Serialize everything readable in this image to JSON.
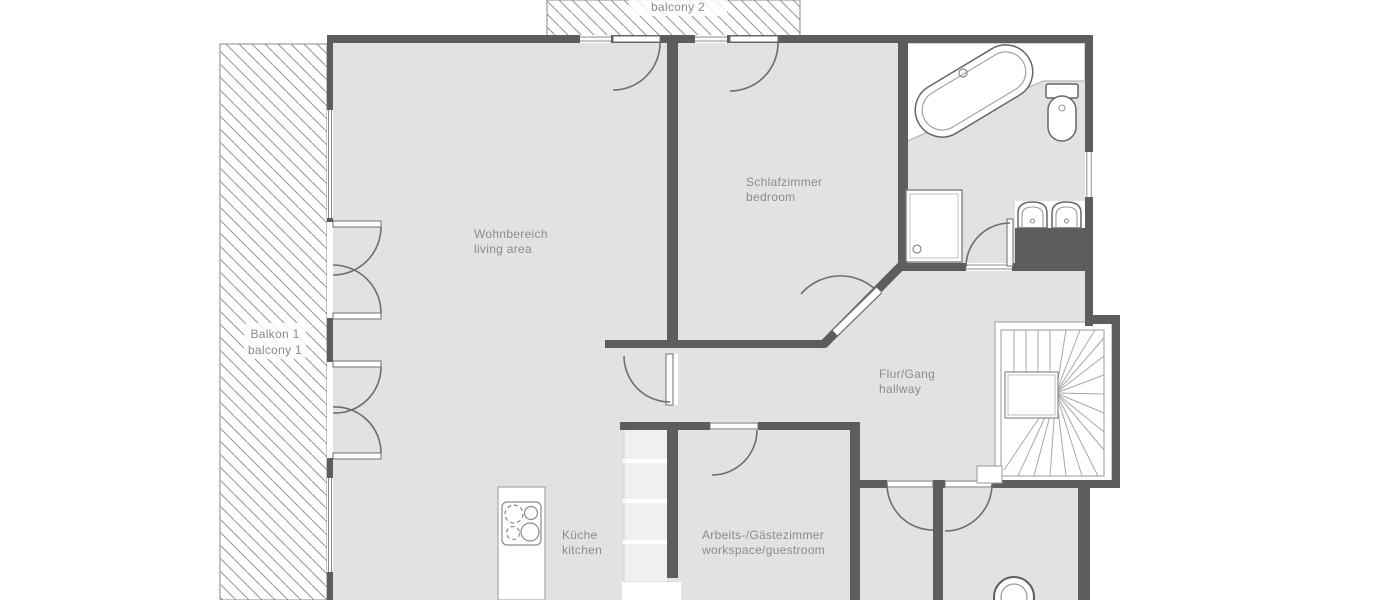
{
  "plan": {
    "type": "apartment-floor-plan",
    "rooms": {
      "balcony2": {
        "line2": "balcony 2"
      },
      "balcony1": {
        "line1": "Balkon 1",
        "line2": "balcony 1"
      },
      "living": {
        "line1": "Wohnbereich",
        "line2": "living area"
      },
      "bedroom": {
        "line1": "Schlafzimmer",
        "line2": "bedroom"
      },
      "hallway": {
        "line1": "Flur/Gang",
        "line2": "hallway"
      },
      "kitchen": {
        "line1": "Küche",
        "line2": "kitchen"
      },
      "workspace": {
        "line1": "Arbeits-/Gästezimmer",
        "line2": "workspace/guestroom"
      }
    },
    "colors": {
      "floor": "#e2e2e2",
      "wall": "#5d5d5d",
      "label_text": "#8c8c8c",
      "hatch_line": "#949494",
      "fixture_outline": "#666666"
    }
  }
}
